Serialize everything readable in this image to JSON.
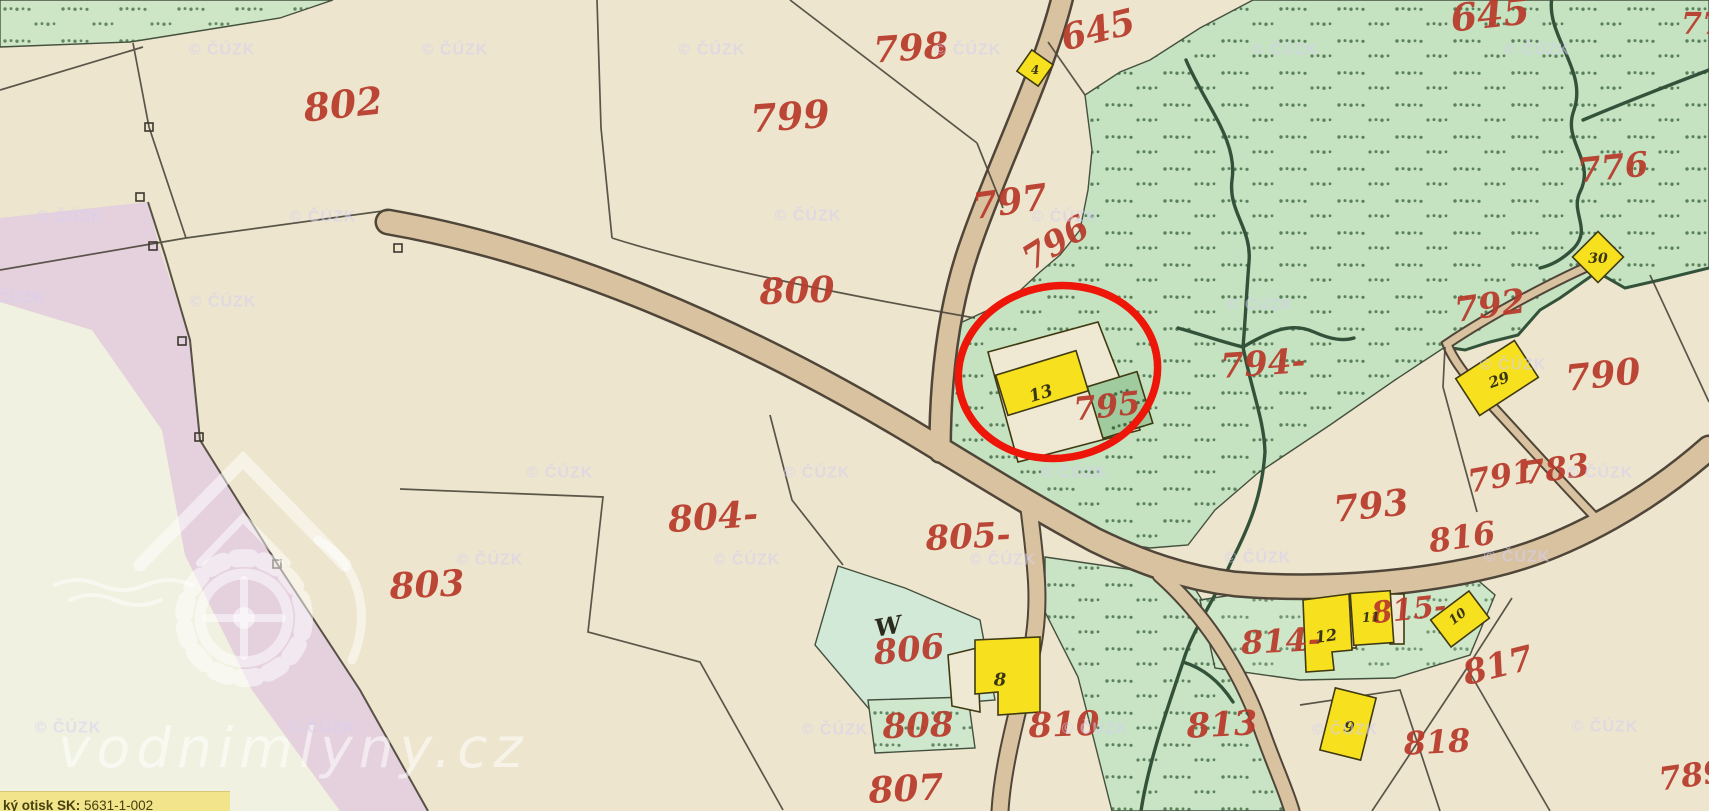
{
  "map": {
    "description": "Historical cadastral map sheet (imperial imprint) in vodnimlyny.cz map viewer",
    "tooltip": {
      "label_bold": "ký otisk SK:",
      "value": "5631-1-002"
    },
    "watermarks": {
      "copyright": "© ČÚZK",
      "site": "vodnimlyny.cz"
    },
    "highlight": {
      "shape": "red ellipse annotation",
      "around": "building 13 on parcel 795"
    },
    "colors": {
      "paper": "#ede5cd",
      "green": "#c5e2c1",
      "green_dark_dots": "#36603a",
      "road": "#d9c2a0",
      "pink_band": "#e5d0de",
      "pale_field": "#f0f1e0",
      "building_yellow": "#f7e11f",
      "parcel_number_red": "#b93a2b",
      "highlight_red": "#ee1509",
      "stream": "#33523a",
      "tooltip_yellow": "#f2e48b"
    },
    "parcel_labels": [
      {
        "label": "802",
        "x": 343,
        "y": 104,
        "rot": -6,
        "size": 38
      },
      {
        "label": "798",
        "x": 911,
        "y": 48,
        "rot": -4,
        "size": 36
      },
      {
        "label": "645",
        "x": 1098,
        "y": 30,
        "rot": -14,
        "size": 36
      },
      {
        "label": "645",
        "x": 1490,
        "y": 14,
        "rot": -6,
        "size": 38
      },
      {
        "label": "77",
        "x": 1702,
        "y": 24,
        "rot": 0,
        "size": 30
      },
      {
        "label": "799",
        "x": 790,
        "y": 116,
        "rot": -4,
        "size": 38
      },
      {
        "label": "797",
        "x": 1010,
        "y": 202,
        "rot": -8,
        "size": 36
      },
      {
        "label": "796",
        "x": 1056,
        "y": 243,
        "rot": -32,
        "size": 34
      },
      {
        "label": "776",
        "x": 1613,
        "y": 168,
        "rot": -6,
        "size": 34
      },
      {
        "label": "800",
        "x": 797,
        "y": 291,
        "rot": -2,
        "size": 36
      },
      {
        "label": "792",
        "x": 1490,
        "y": 306,
        "rot": -8,
        "size": 34
      },
      {
        "label": "794-",
        "x": 1263,
        "y": 364,
        "rot": -4,
        "size": 34
      },
      {
        "label": "790",
        "x": 1603,
        "y": 375,
        "rot": -6,
        "size": 36
      },
      {
        "label": "795",
        "x": 1107,
        "y": 406,
        "rot": -6,
        "size": 32
      },
      {
        "label": "804-",
        "x": 713,
        "y": 517,
        "rot": -4,
        "size": 36
      },
      {
        "label": "805-",
        "x": 968,
        "y": 537,
        "rot": -3,
        "size": 34
      },
      {
        "label": "803",
        "x": 427,
        "y": 585,
        "rot": -3,
        "size": 36
      },
      {
        "label": "793",
        "x": 1371,
        "y": 506,
        "rot": -6,
        "size": 36
      },
      {
        "label": "791",
        "x": 1501,
        "y": 476,
        "rot": -10,
        "size": 32
      },
      {
        "label": "783",
        "x": 1556,
        "y": 469,
        "rot": -8,
        "size": 32
      },
      {
        "label": "816",
        "x": 1462,
        "y": 537,
        "rot": -8,
        "size": 32
      },
      {
        "label": "806",
        "x": 909,
        "y": 650,
        "rot": -6,
        "size": 34
      },
      {
        "label": "814-",
        "x": 1281,
        "y": 641,
        "rot": -3,
        "size": 32
      },
      {
        "label": "815-",
        "x": 1409,
        "y": 610,
        "rot": -6,
        "size": 30
      },
      {
        "label": "817",
        "x": 1498,
        "y": 666,
        "rot": -14,
        "size": 34
      },
      {
        "label": "810",
        "x": 1064,
        "y": 725,
        "rot": -2,
        "size": 34
      },
      {
        "label": "808",
        "x": 918,
        "y": 726,
        "rot": -2,
        "size": 34
      },
      {
        "label": "813",
        "x": 1222,
        "y": 725,
        "rot": -3,
        "size": 34
      },
      {
        "label": "818",
        "x": 1437,
        "y": 742,
        "rot": -3,
        "size": 32
      },
      {
        "label": "807",
        "x": 906,
        "y": 789,
        "rot": -3,
        "size": 36
      },
      {
        "label": "789",
        "x": 1692,
        "y": 775,
        "rot": -8,
        "size": 32
      }
    ],
    "building_labels": [
      {
        "label": "13",
        "x": 1041,
        "y": 394,
        "rot": -17,
        "size": 17
      },
      {
        "label": "8",
        "x": 1000,
        "y": 680,
        "rot": 0,
        "size": 18
      },
      {
        "label": "4",
        "x": 1035,
        "y": 70,
        "rot": 0,
        "size": 12
      },
      {
        "label": "30",
        "x": 1598,
        "y": 259,
        "rot": 0,
        "size": 14
      },
      {
        "label": "29",
        "x": 1499,
        "y": 380,
        "rot": -20,
        "size": 15
      },
      {
        "label": "12",
        "x": 1326,
        "y": 636,
        "rot": -8,
        "size": 16
      },
      {
        "label": "11",
        "x": 1371,
        "y": 618,
        "rot": -4,
        "size": 13
      },
      {
        "label": "10",
        "x": 1458,
        "y": 617,
        "rot": -38,
        "size": 13
      },
      {
        "label": "9",
        "x": 1349,
        "y": 727,
        "rot": 12,
        "size": 15
      }
    ],
    "symbol_labels": [
      {
        "label": "W",
        "x": 888,
        "y": 626,
        "rot": -10,
        "size": 24
      }
    ],
    "copyright_positions": [
      [
        222,
        50
      ],
      [
        455,
        50
      ],
      [
        712,
        50
      ],
      [
        968,
        50
      ],
      [
        1285,
        50
      ],
      [
        1537,
        50
      ],
      [
        70,
        217
      ],
      [
        323,
        217
      ],
      [
        808,
        216
      ],
      [
        1065,
        217
      ],
      [
        12,
        298
      ],
      [
        223,
        302
      ],
      [
        1260,
        305
      ],
      [
        1513,
        365
      ],
      [
        560,
        473
      ],
      [
        817,
        473
      ],
      [
        1074,
        473
      ],
      [
        1600,
        473
      ],
      [
        490,
        560
      ],
      [
        747,
        560
      ],
      [
        1003,
        560
      ],
      [
        1258,
        558
      ],
      [
        1517,
        557
      ],
      [
        68,
        728
      ],
      [
        322,
        728
      ],
      [
        835,
        730
      ],
      [
        1095,
        729
      ],
      [
        1345,
        730
      ],
      [
        1605,
        727
      ]
    ]
  }
}
